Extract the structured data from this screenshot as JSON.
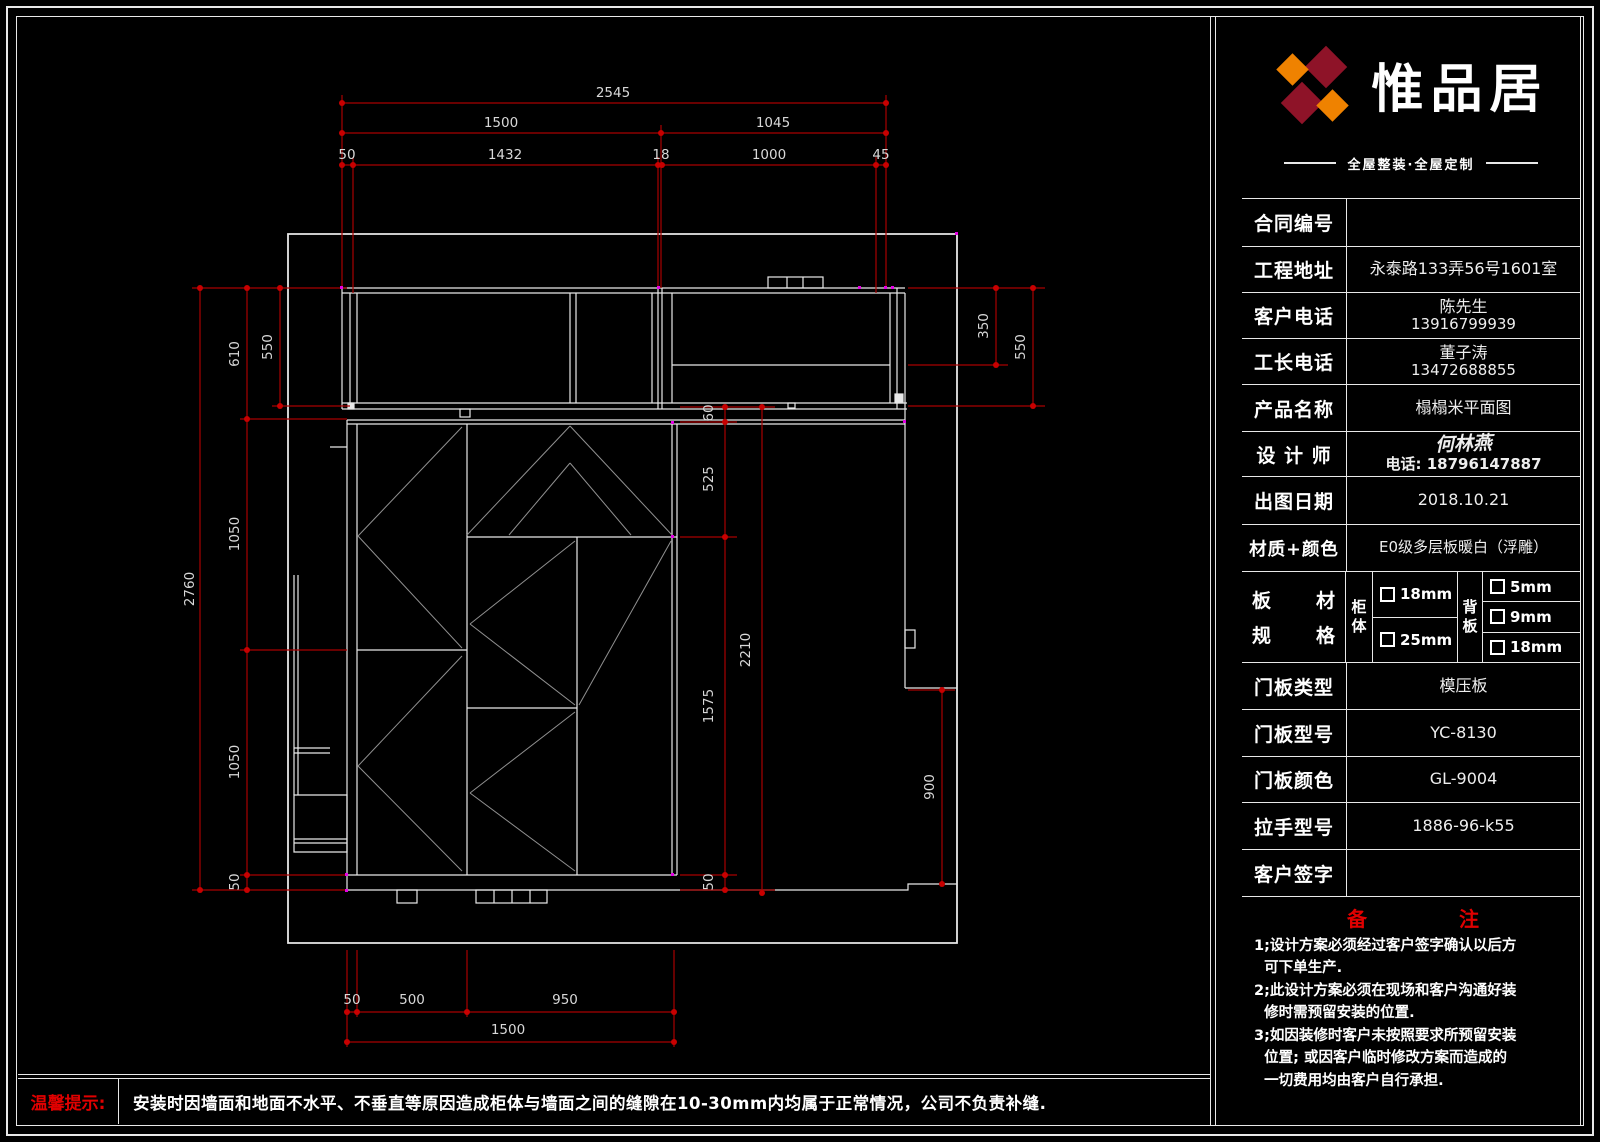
{
  "logo": {
    "name": "惟品居",
    "tagline": "全屋整装·全屋定制"
  },
  "fields": [
    {
      "label": "合同编号",
      "value": ""
    },
    {
      "label": "工程地址",
      "value": "永泰路133弄56号1601室"
    },
    {
      "label": "客户电话",
      "value": "陈先生",
      "value2": "13916799939"
    },
    {
      "label": "工长电话",
      "value": "董子涛",
      "value2": "13472688855"
    },
    {
      "label": "产品名称",
      "value": "榻榻米平面图"
    },
    {
      "label": "设 计 师",
      "value": "何林燕",
      "value2": "电话: 18796147887"
    },
    {
      "label": "出图日期",
      "value": "2018.10.21"
    },
    {
      "label": "材质+颜色",
      "value": "E0级多层板暖白（浮雕）"
    },
    {
      "label": "门板类型",
      "value": "模压板"
    },
    {
      "label": "门板型号",
      "value": "YC-8130"
    },
    {
      "label": "门板颜色",
      "value": "GL-9004"
    },
    {
      "label": "拉手型号",
      "value": "1886-96-k55"
    },
    {
      "label": "客户签字",
      "value": ""
    }
  ],
  "board_spec": {
    "l1a": "板",
    "l1b": "材",
    "l2a": "规",
    "l2b": "格",
    "cab1": "柜",
    "cab2": "体",
    "back1": "背",
    "back2": "板",
    "cabinet_options": [
      "18mm",
      "25mm"
    ],
    "back_options": [
      "5mm",
      "9mm",
      "18mm"
    ]
  },
  "notes": {
    "t1": "备",
    "t2": "注",
    "items": [
      "1;设计方案必须经过客户签字确认以后方\n  可下单生产.",
      "2;此设计方案必须在现场和客户沟通好装\n  修时需预留安装的位置.",
      "3;如因装修时客户未按照要求所预留安装\n  位置; 或因客户临时修改方案而造成的\n  一切费用均由客户自行承担."
    ]
  },
  "footer": {
    "label": "温馨提示:",
    "message": "安装时因墙面和地面不水平、不垂直等原因造成柜体与墙面之间的缝隙在10-30mm内均属于正常情况，公司不负责补缝."
  },
  "dims": {
    "top_total": "2545",
    "top_1500": "1500",
    "top_1045": "1045",
    "top_50": "50",
    "top_1432": "1432",
    "top_18": "18",
    "top_1000": "1000",
    "top_45": "45",
    "left_2760": "2760",
    "left_610": "610",
    "left_550": "550",
    "left_1050a": "1050",
    "left_1050b": "1050",
    "left_50": "50",
    "right_350": "350",
    "right_550": "550",
    "in_60": "60",
    "in_525": "525",
    "in_2210": "2210",
    "in_1575": "1575",
    "in_50": "50",
    "in_900": "900",
    "bot_50": "50",
    "bot_500": "500",
    "bot_950": "950",
    "bot_1500": "1500"
  }
}
